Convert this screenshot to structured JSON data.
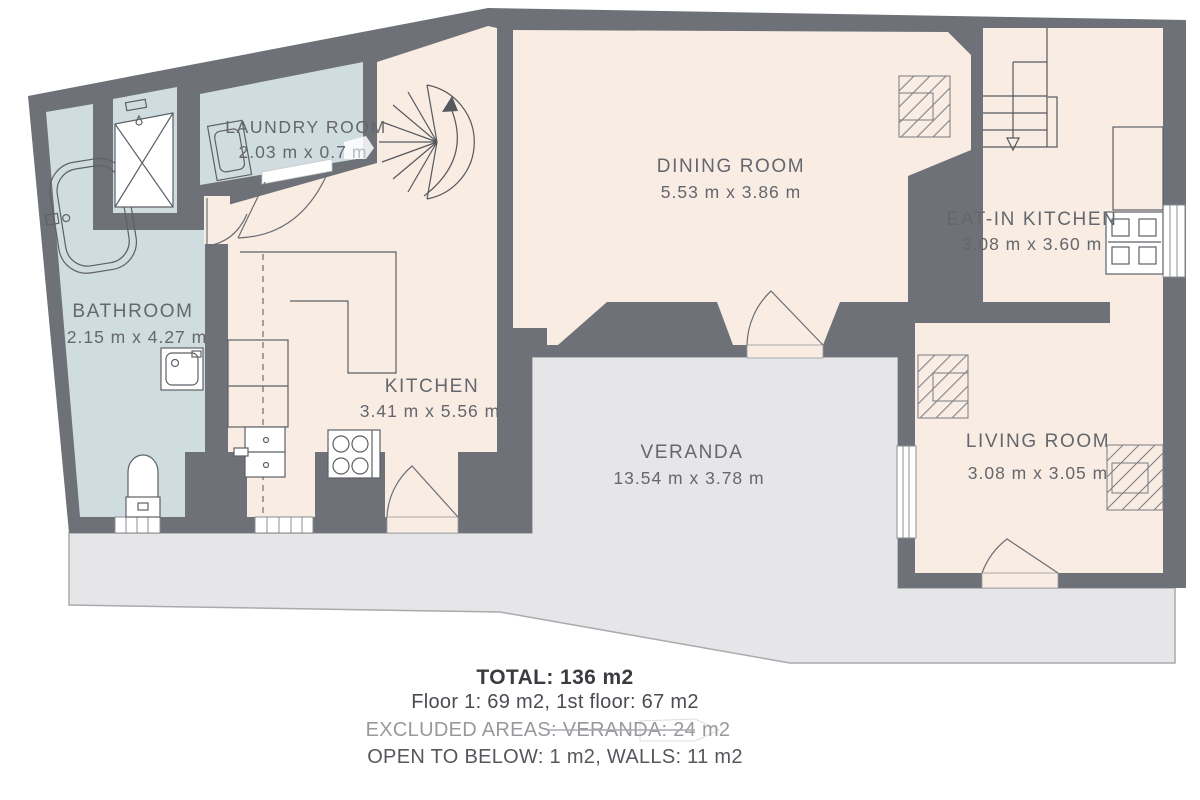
{
  "rooms": {
    "bathroom": {
      "name": "BATHROOM",
      "dims": "2.15 m x 4.27 m"
    },
    "laundry": {
      "name": "LAUNDRY ROOM",
      "dims": "2.03 m x 0.7",
      "dims_suffix": "m"
    },
    "kitchen": {
      "name": "KITCHEN",
      "dims": "3.41 m x 5.56 m"
    },
    "dining": {
      "name": "DINING ROOM",
      "dims": "5.53 m x 3.86 m"
    },
    "eat_in_kitchen": {
      "name": "EAT-IN KITCHEN",
      "dims": "3.08 m x 3.60 m"
    },
    "living": {
      "name": "LIVING ROOM",
      "dims": "3.08 m x 3.05 m"
    },
    "veranda": {
      "name": "VERANDA",
      "dims": "13.54 m x 3.78 m"
    }
  },
  "summary": {
    "total": "TOTAL: 136 m2",
    "floors": "Floor 1: 69 m2, 1st floor: 67 m2",
    "excluded_areas": "EXCLUDED AREAS: VERANDA: 24 m2",
    "open_to_below": "OPEN TO BELOW: 1 m2,  WALLS: 11 m2"
  },
  "colors": {
    "wall": "#6e7177",
    "room_fill": "#f8ece3",
    "wet_room_fill": "#cfdde0",
    "veranda_fill": "#e6e6e9",
    "label_text": "#64676d",
    "summary_dark": "#393b41",
    "summary_muted": "#97999d"
  }
}
